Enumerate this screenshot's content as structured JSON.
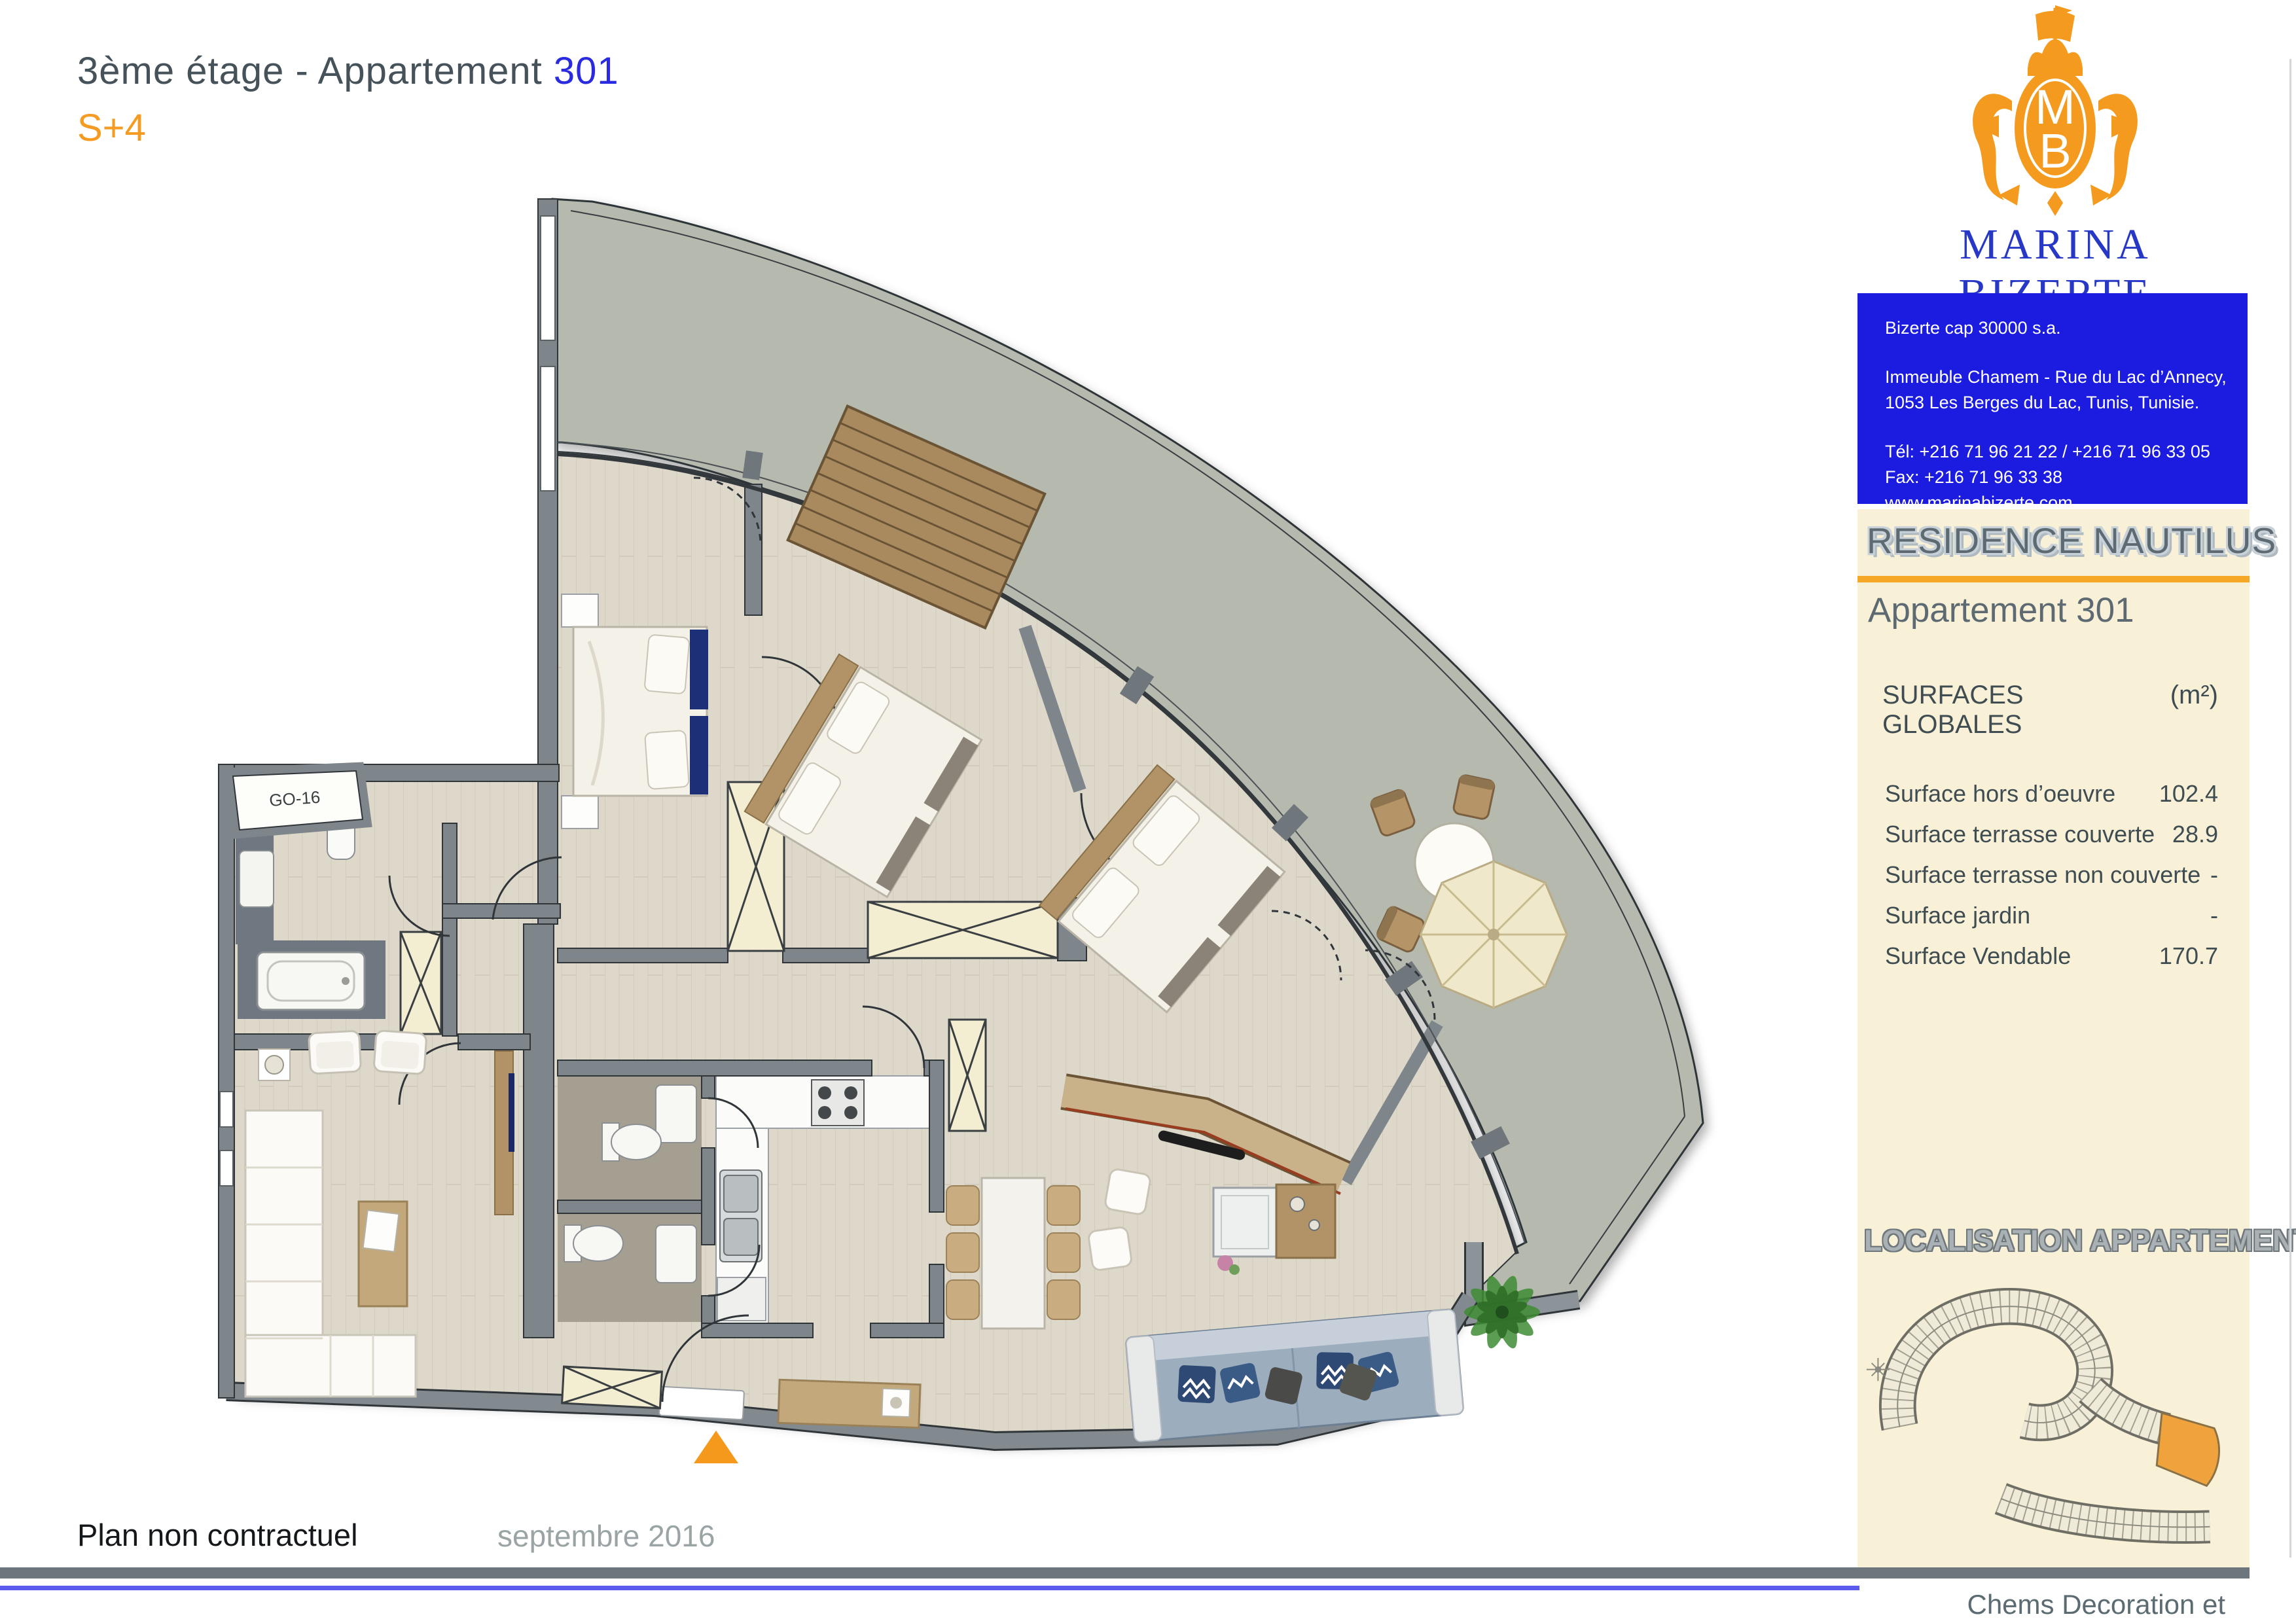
{
  "header": {
    "title_prefix": "3ème étage - Appartement ",
    "title_number": "301",
    "type_label": "S+4"
  },
  "logo": {
    "monogram_top": "M",
    "monogram_bottom": "B",
    "brand": "MARINA BIZERTE",
    "country": "TUNISIA"
  },
  "contact": {
    "line1": "Bizerte cap 30000 s.a.",
    "line2": "Immeuble Chamem - Rue du Lac d’Annecy,",
    "line3": "1053 Les Berges du Lac, Tunis, Tunisie.",
    "line4": "Tél: +216 71 96 21 22 / +216 71 96 33 05",
    "line5": "Fax: +216 71 96 33 38",
    "line6": "www.marinabizerte.com"
  },
  "panel": {
    "residence": "RESIDENCE NAUTILUS",
    "apartment": "Appartement 301",
    "surfaces": {
      "header": "SURFACES GLOBALES",
      "unit": "(m²)",
      "rows": [
        {
          "label": "Surface hors d’oeuvre",
          "value": "102.4"
        },
        {
          "label": "Surface terrasse couverte",
          "value": "28.9"
        },
        {
          "label": "Surface terrasse non couverte",
          "value": "-"
        },
        {
          "label": "Surface jardin",
          "value": "-"
        },
        {
          "label": "Surface Vendable",
          "value": "170.7"
        }
      ]
    },
    "localisation": "LOCALISATION APPARTEMENT"
  },
  "plan": {
    "room_label": "GO-16"
  },
  "footer": {
    "note": "Plan non contractuel",
    "date": "septembre 2016",
    "credit": "Chems Decoration et Agencement"
  },
  "colors": {
    "accent_orange": "#f59b21",
    "number_blue": "#2a2ae0",
    "box_blue": "#1c1ce1",
    "brand_blue": "#2737c6",
    "panel_cream": "#f8f1d8",
    "terrace_gray": "#b5b9ae",
    "floor_wood": "#ded8ca",
    "wall_gray": "#7e868b",
    "slate_text": "#46525a"
  }
}
